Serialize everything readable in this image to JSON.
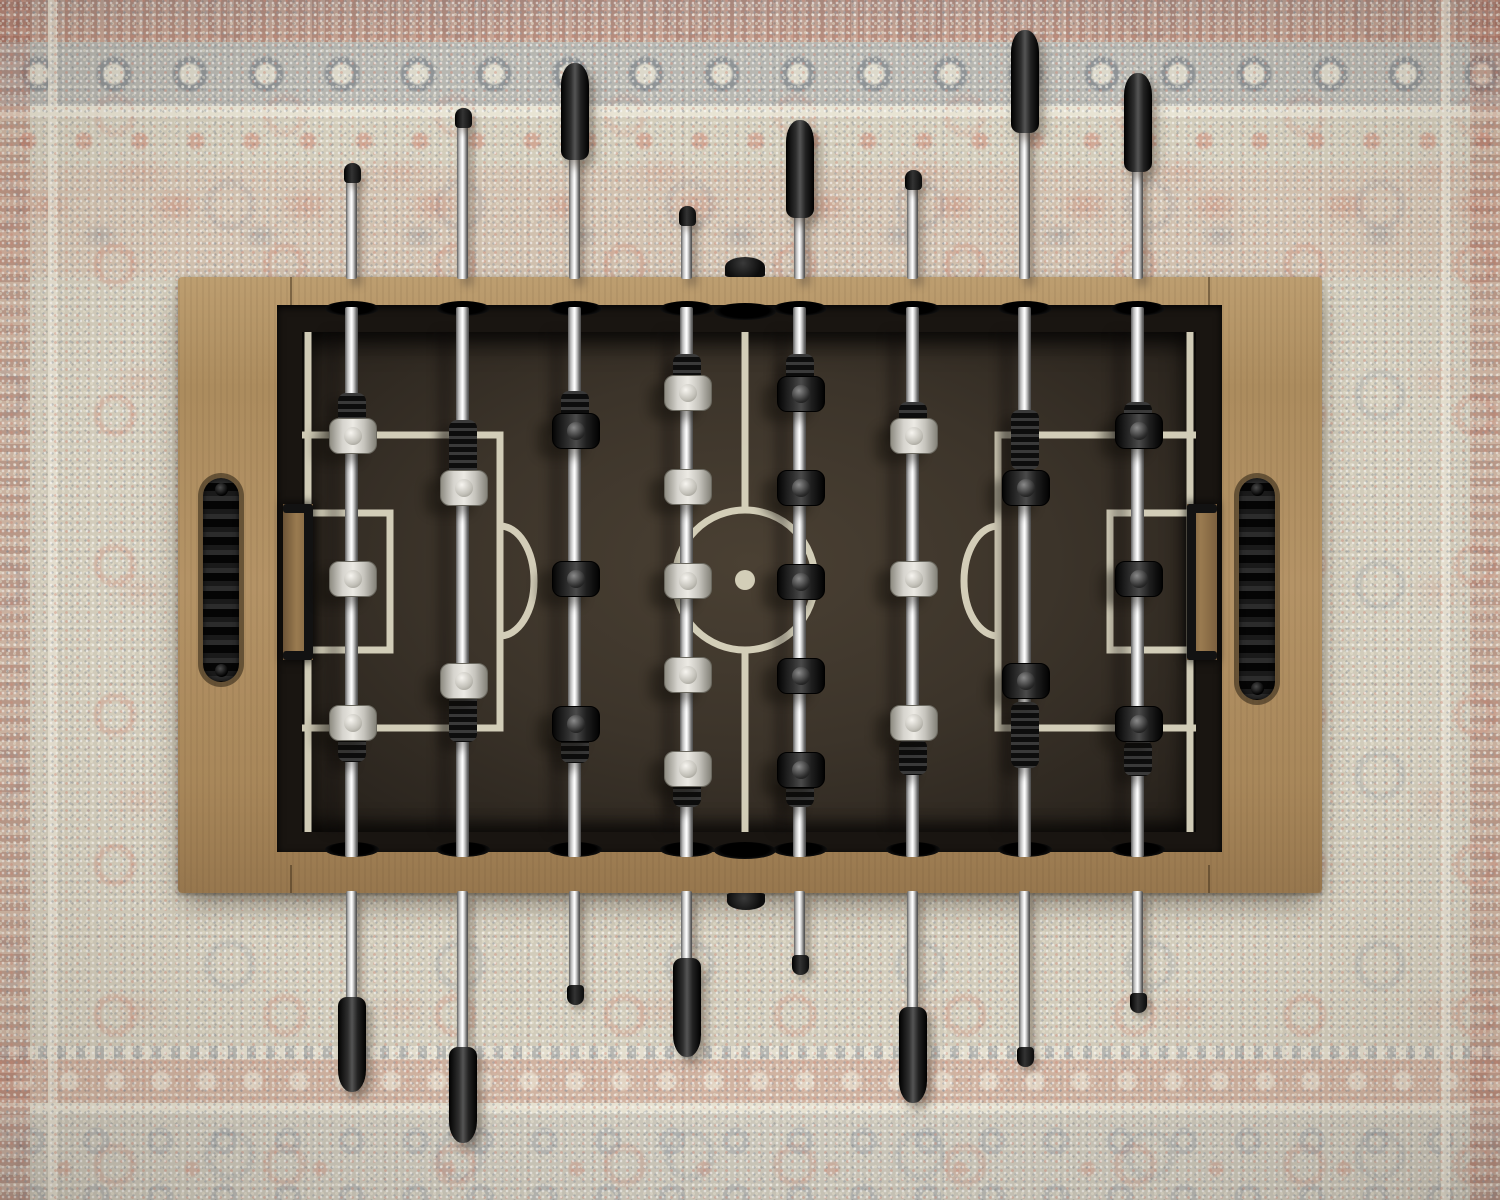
{
  "scene": {
    "type": "photograph",
    "description": "Top-down overhead photo of a foosball (table soccer) table standing on a faded oriental area rug",
    "objects": [
      "foosball table",
      "oriental rug"
    ],
    "teams": [
      {
        "name": "white",
        "rods": [
          1,
          2,
          4,
          6
        ],
        "handle_side": "bottom"
      },
      {
        "name": "black",
        "rods": [
          3,
          5,
          7,
          8
        ],
        "handle_side": "top"
      }
    ]
  },
  "palette": {
    "rug_base": "#d2ccbb",
    "rug_cream": "#e8e3d0",
    "rug_coral": "#ce7c68",
    "rug_gray": "#8b95a0",
    "wood": "#b09264",
    "wood_dark": "#8a6c46",
    "wall": "#191511",
    "floor": "#3c342a",
    "line": "#dbd6c0",
    "chrome": "#e8e8e8",
    "grip": "#141414",
    "team_white": "#d8d6d0",
    "team_black": "#232323"
  },
  "table": {
    "x": 178,
    "y": 277,
    "w": 1144,
    "h": 616,
    "recess": {
      "x": 99,
      "y": 28,
      "w": 945,
      "h": 547
    },
    "floor": {
      "x": 124,
      "y": 55,
      "w": 894,
      "h": 500
    },
    "rod_hole": {
      "w": 54,
      "h": 15,
      "top_y": 24,
      "bottom_y": 565
    },
    "ball_holes": {
      "w": 62,
      "h": 17,
      "cx": 567,
      "top_y": 26,
      "bottom_y": 565
    },
    "serve_knobs": [
      {
        "pos": "top",
        "x": 547,
        "y": -20,
        "w": 40,
        "h": 20
      },
      {
        "pos": "bottom",
        "x": 549,
        "y": 616,
        "w": 38,
        "h": 17
      }
    ],
    "side_handles": [
      {
        "side": "left",
        "x": 25,
        "y": 201,
        "w": 36,
        "h": 204
      },
      {
        "side": "right",
        "x": 1061,
        "y": 201,
        "w": 36,
        "h": 222
      }
    ],
    "goals": [
      {
        "side": "left",
        "x": 105,
        "y": 227,
        "w": 30,
        "h": 156
      },
      {
        "side": "right",
        "x": 1009,
        "y": 227,
        "w": 30,
        "h": 156
      }
    ],
    "rail_seams": [
      {
        "x": 112,
        "y": 0,
        "h": 28
      },
      {
        "x": 1030,
        "y": 0,
        "h": 28
      },
      {
        "x": 112,
        "y": 588,
        "h": 28
      },
      {
        "x": 1030,
        "y": 588,
        "h": 28
      }
    ]
  },
  "markings": {
    "stroke_width": 7,
    "circle": {
      "cx": 567,
      "cy": 303,
      "r": 70
    },
    "dot_r": 10,
    "paths": [
      {
        "name": "goal-line-left",
        "d": "M130 55 V555"
      },
      {
        "name": "goal-line-right",
        "d": "M1012 55 V555"
      },
      {
        "name": "center-line-top",
        "d": "M567 55 V233"
      },
      {
        "name": "center-line-bottom",
        "d": "M567 373 V555"
      },
      {
        "name": "penalty-box-left",
        "d": "M124 158 H322 V451 H124"
      },
      {
        "name": "goal-box-left",
        "d": "M124 236 H212 V373 H124"
      },
      {
        "name": "penalty-arc-left",
        "d": "M322 249 A34 55 0 0 1 322 359"
      },
      {
        "name": "penalty-box-right",
        "d": "M1018 158 H820 V451 H1018"
      },
      {
        "name": "goal-box-right",
        "d": "M1018 236 H932 V373 H1018"
      },
      {
        "name": "penalty-arc-right",
        "d": "M820 249 A34 55 0 0 0 820 359"
      }
    ]
  },
  "rods": [
    {
      "id": 1,
      "x": 352,
      "team": "white",
      "role": "goalie",
      "players": [
        435,
        578,
        722
      ],
      "bumpers": [
        {
          "y": 411,
          "h": 36
        },
        {
          "y": 744,
          "h": 36
        }
      ],
      "top": {
        "type": "cap",
        "tip": 163,
        "len": 20
      },
      "bottom": {
        "type": "handle",
        "tip": 997,
        "len": 95
      }
    },
    {
      "id": 2,
      "x": 463,
      "team": "white",
      "role": "defense",
      "players": [
        487,
        680
      ],
      "bumpers": [
        {
          "y": 450,
          "h": 60
        },
        {
          "y": 712,
          "h": 60
        }
      ],
      "top": {
        "type": "cap",
        "tip": 108,
        "len": 20
      },
      "bottom": {
        "type": "handle",
        "tip": 1047,
        "len": 96
      }
    },
    {
      "id": 3,
      "x": 575,
      "team": "black",
      "role": "attack",
      "players": [
        430,
        578,
        723
      ],
      "bumpers": [
        {
          "y": 409,
          "h": 36
        },
        {
          "y": 745,
          "h": 36
        }
      ],
      "top": {
        "type": "handle",
        "tip": 63,
        "len": 97
      },
      "bottom": {
        "type": "cap",
        "tip": 985,
        "len": 20
      }
    },
    {
      "id": 4,
      "x": 687,
      "team": "white",
      "role": "midfield",
      "players": [
        392,
        486,
        580,
        674,
        768
      ],
      "bumpers": [
        {
          "y": 371,
          "h": 34
        },
        {
          "y": 790,
          "h": 34
        }
      ],
      "top": {
        "type": "cap",
        "tip": 206,
        "len": 20
      },
      "bottom": {
        "type": "handle",
        "tip": 958,
        "len": 99
      }
    },
    {
      "id": 5,
      "x": 800,
      "team": "black",
      "role": "midfield",
      "players": [
        393,
        487,
        581,
        675,
        769
      ],
      "bumpers": [
        {
          "y": 371,
          "h": 34
        },
        {
          "y": 790,
          "h": 34
        }
      ],
      "top": {
        "type": "handle",
        "tip": 120,
        "len": 98
      },
      "bottom": {
        "type": "cap",
        "tip": 955,
        "len": 20
      }
    },
    {
      "id": 6,
      "x": 913,
      "team": "white",
      "role": "attack",
      "players": [
        435,
        578,
        722
      ],
      "bumpers": [
        {
          "y": 420,
          "h": 36
        },
        {
          "y": 757,
          "h": 36
        }
      ],
      "top": {
        "type": "cap",
        "tip": 170,
        "len": 20
      },
      "bottom": {
        "type": "handle",
        "tip": 1007,
        "len": 96
      }
    },
    {
      "id": 7,
      "x": 1025,
      "team": "black",
      "role": "defense",
      "players": [
        487,
        680
      ],
      "bumpers": [
        {
          "y": 440,
          "h": 60
        },
        {
          "y": 735,
          "h": 66
        }
      ],
      "top": {
        "type": "handle",
        "tip": 30,
        "len": 103
      },
      "bottom": {
        "type": "cap",
        "tip": 1047,
        "len": 20
      }
    },
    {
      "id": 8,
      "x": 1138,
      "team": "black",
      "role": "goalie",
      "players": [
        430,
        578,
        723
      ],
      "bumpers": [
        {
          "y": 420,
          "h": 36
        },
        {
          "y": 758,
          "h": 36
        }
      ],
      "top": {
        "type": "handle",
        "tip": 73,
        "len": 99
      },
      "bottom": {
        "type": "cap",
        "tip": 993,
        "len": 20
      }
    }
  ]
}
